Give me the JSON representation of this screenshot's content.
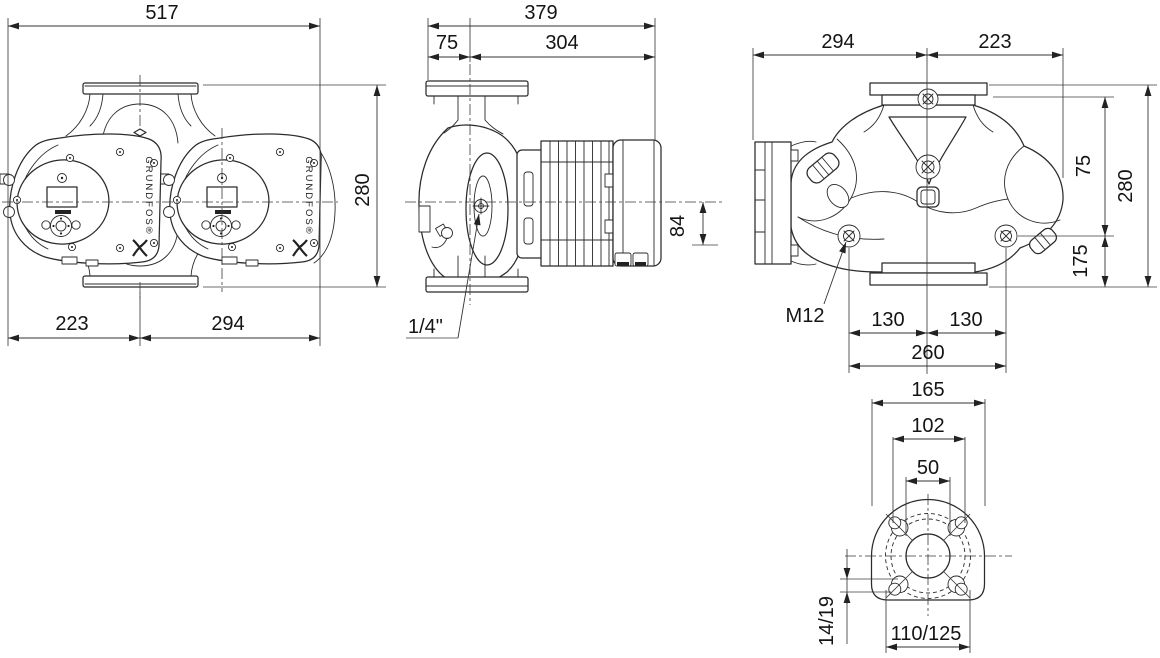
{
  "drawing": {
    "brand": "GRUNDFOS®",
    "front": {
      "w_total": "517",
      "h": "280",
      "w_left": "223",
      "w_right": "294"
    },
    "side": {
      "l_total": "379",
      "l_front": "75",
      "l_back": "304",
      "h_box": "84",
      "vent": "1/4\""
    },
    "back": {
      "w_left": "294",
      "w_right": "223",
      "h_top": "75",
      "h_total": "280",
      "h_bottom": "175",
      "bolt": "M12",
      "b_left": "130",
      "b_right": "130",
      "b_total": "260"
    },
    "flange": {
      "d_outer": "165",
      "d_holes": "102",
      "d_bore": "50",
      "d_hole": "14/19",
      "d_circle": "110/125"
    }
  }
}
